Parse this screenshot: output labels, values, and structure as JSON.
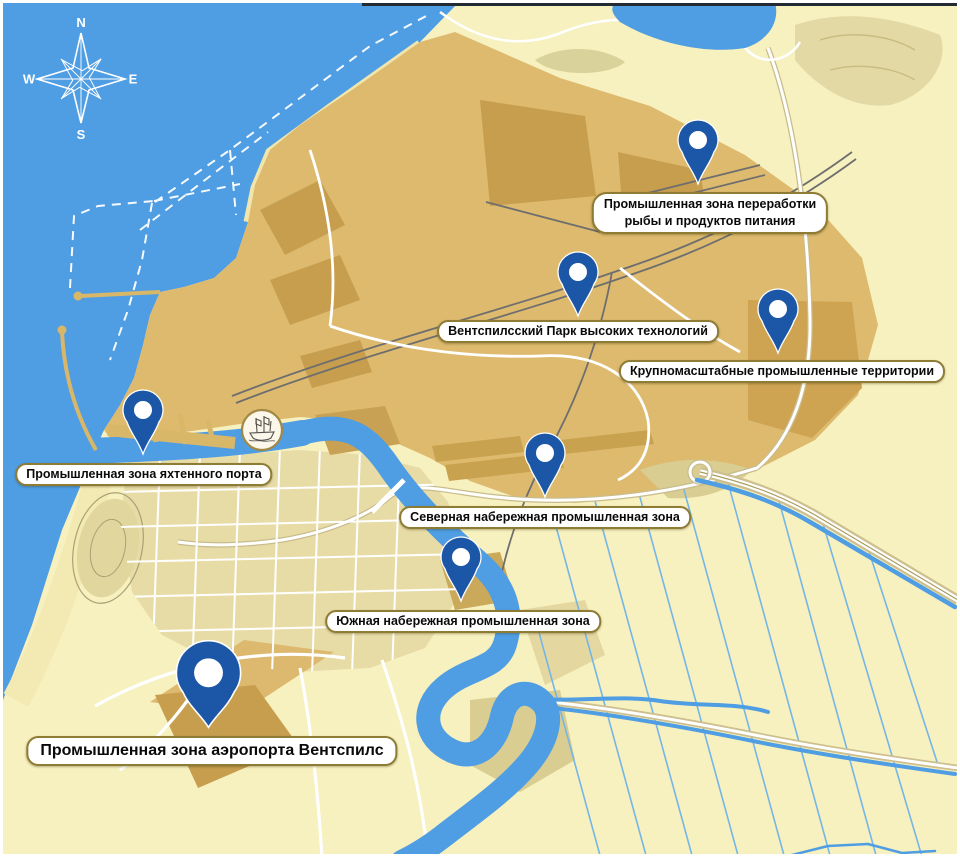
{
  "compass": {
    "n": "N",
    "e": "E",
    "s": "S",
    "w": "W"
  },
  "zones": [
    {
      "name": "fish-food-processing",
      "label": "Промышленная зона переработки рыбы и продуктов питания",
      "line1": "Промышленная зона переработки",
      "line2": "рыбы и продуктов питания"
    },
    {
      "name": "high-tech-park",
      "label": "Вентспилсский Парк высоких технологий"
    },
    {
      "name": "large-scale-industrial",
      "label": "Крупномасштабные промышленные территории"
    },
    {
      "name": "yacht-port",
      "label": "Промышленная зона яхтенного порта"
    },
    {
      "name": "north-embankment",
      "label": "Северная набережная промышленная зона"
    },
    {
      "name": "south-embankment",
      "label": "Южная набережная промышленная зона"
    },
    {
      "name": "airport",
      "label": "Промышленная зона аэропорта Вентспилс"
    }
  ],
  "icons": {
    "compass_rose": "eight-point star with N E S W",
    "ship_emblem": "old sailing ship in round badge",
    "map_pin": "teardrop marker with ring hole"
  },
  "colors": {
    "sea": "#4F9DE3",
    "land_pale": "#F7F0BF",
    "port_tan": "#DDBA6E",
    "industrial_dark": "#C79E4E",
    "city_tan": "#E8DCA6",
    "pin_blue": "#1B57A6",
    "label_border": "#8E7C34",
    "drainage_blue": "#74B6E8"
  }
}
